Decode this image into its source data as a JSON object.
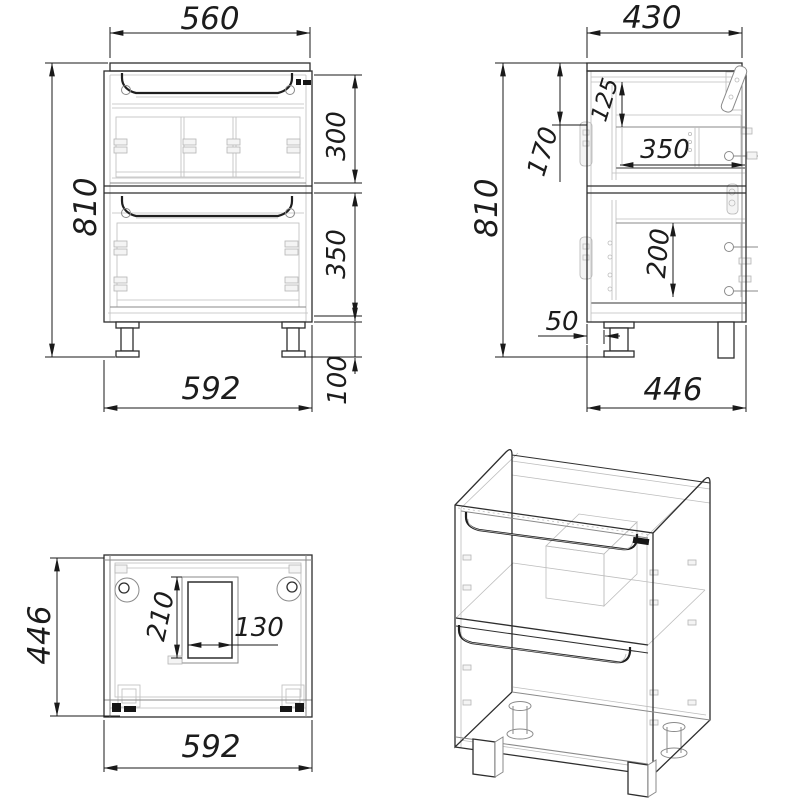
{
  "dims": {
    "front": {
      "top_width": "560",
      "height": "810",
      "upper_section": "300",
      "lower_section": "350",
      "leg_height": "100",
      "width": "592"
    },
    "side": {
      "top_depth": "430",
      "height": "810",
      "back_rail_drop": "170",
      "drawer_top_drop": "125",
      "drawer_depth": "350",
      "lower_inner_height": "200",
      "leg_setback": "50",
      "depth": "446"
    },
    "plan": {
      "depth": "446",
      "cutout_length": "210",
      "cutout_width": "130",
      "width": "592"
    }
  }
}
